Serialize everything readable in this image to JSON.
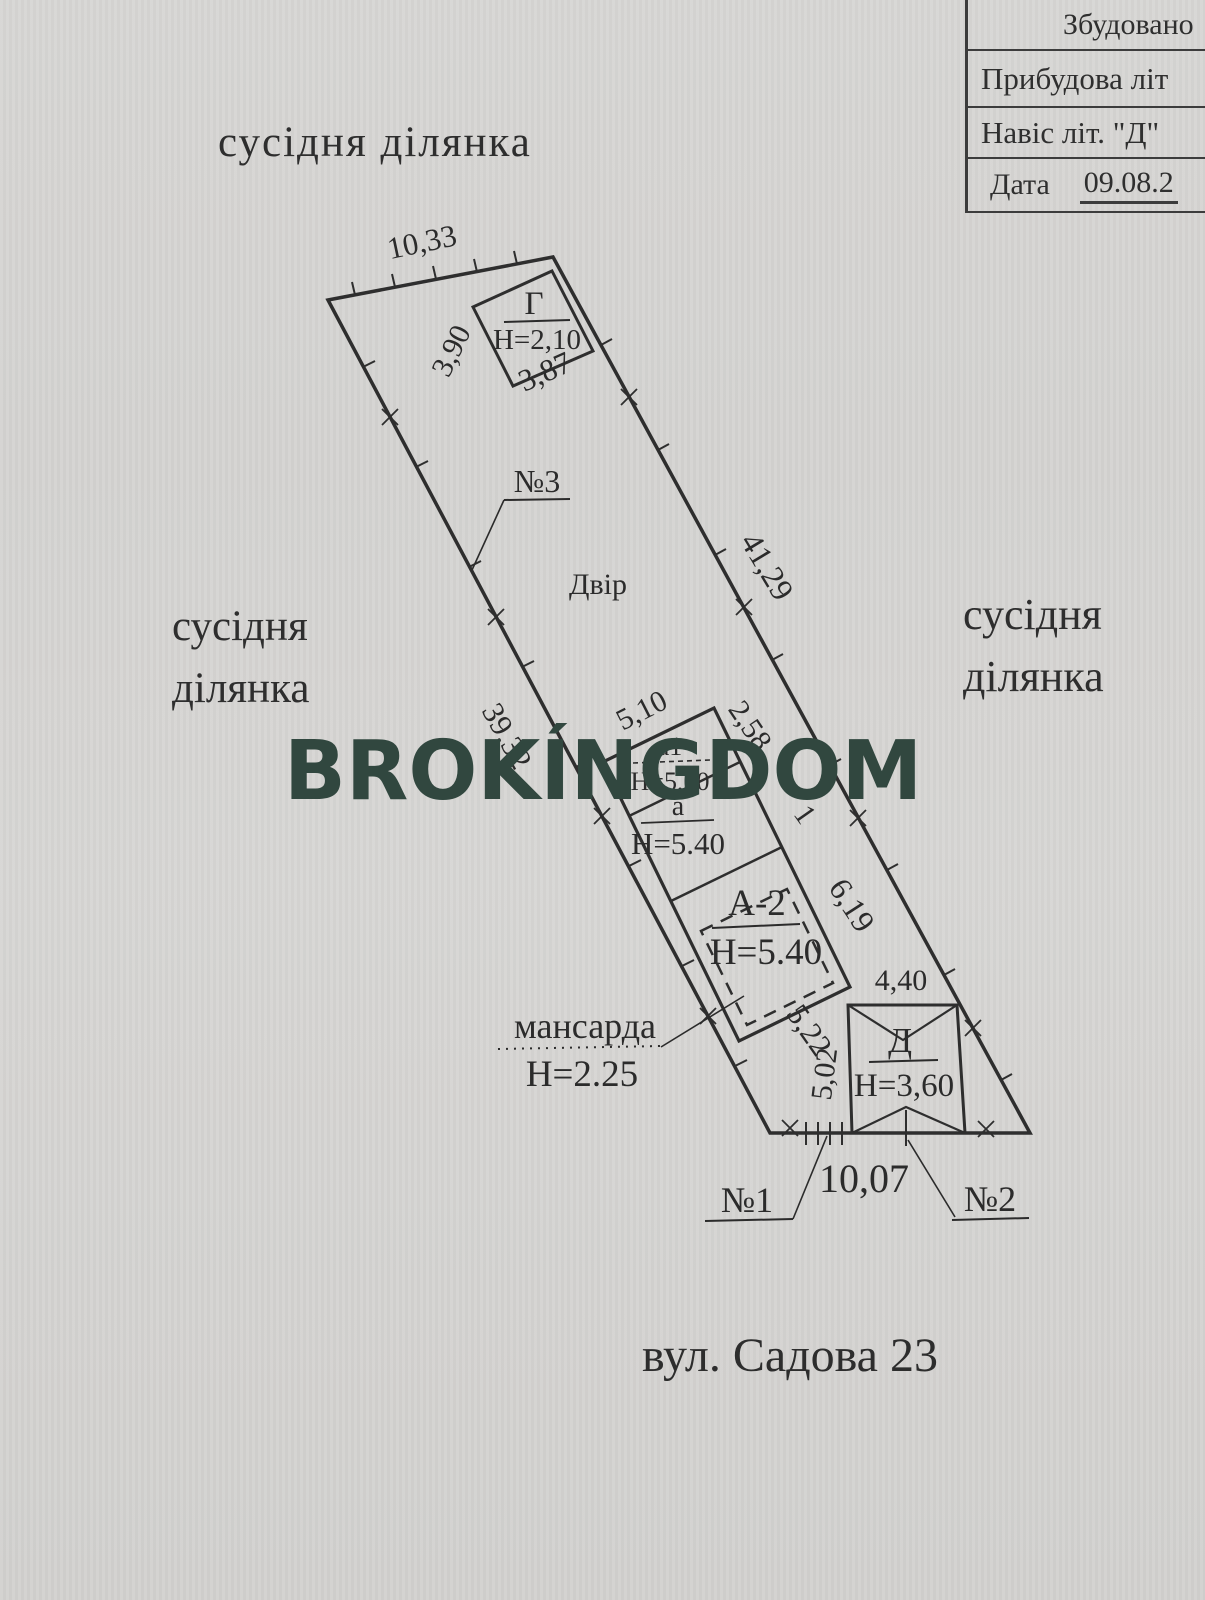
{
  "document": {
    "watermark": "BROKÍNGDOM",
    "watermark_color": "#31473f",
    "street_label": "вул. Садова 23"
  },
  "info_table": {
    "row1": "Збудовано",
    "row2": "Прибудова літ",
    "row3": "Навіс літ. \"Д\"",
    "row4_label": "Дата",
    "row4_value": "09.08.2"
  },
  "neighbors": {
    "top": "сусідня ділянка",
    "left_line1": "сусідня",
    "left_line2": "ділянка",
    "right_line1": "сусідня",
    "right_line2": "ділянка"
  },
  "plot": {
    "yard_label": "Двір",
    "point1": "№1",
    "point2": "№2",
    "point3": "№3",
    "frontage": "10,07"
  },
  "buildings": {
    "garage_g": {
      "label": "Г",
      "height": "H=2,10",
      "side_left": "3,90",
      "side_bottom": "3,87"
    },
    "annex_a1": {
      "label": "a1",
      "height": "H=5,00"
    },
    "annex_a": {
      "label": "a",
      "height": "H=5.40"
    },
    "house_a2": {
      "label": "А-2",
      "height": "H=5.40"
    },
    "attic": {
      "label": "мансарда",
      "height": "H=2.25"
    },
    "canopy_d": {
      "label": "Д",
      "height": "H=3,60",
      "side_top": "4,40",
      "side_left": "5,02"
    }
  },
  "dimensions": {
    "top_edge": "10,33",
    "right_edge_upper": "41,29",
    "left_edge_lower": "39,32",
    "house_top": "5,10",
    "house_right_upper": "2,58",
    "house_right_lower": "6,19",
    "house_bottom": "5,22",
    "fragment": "1"
  }
}
